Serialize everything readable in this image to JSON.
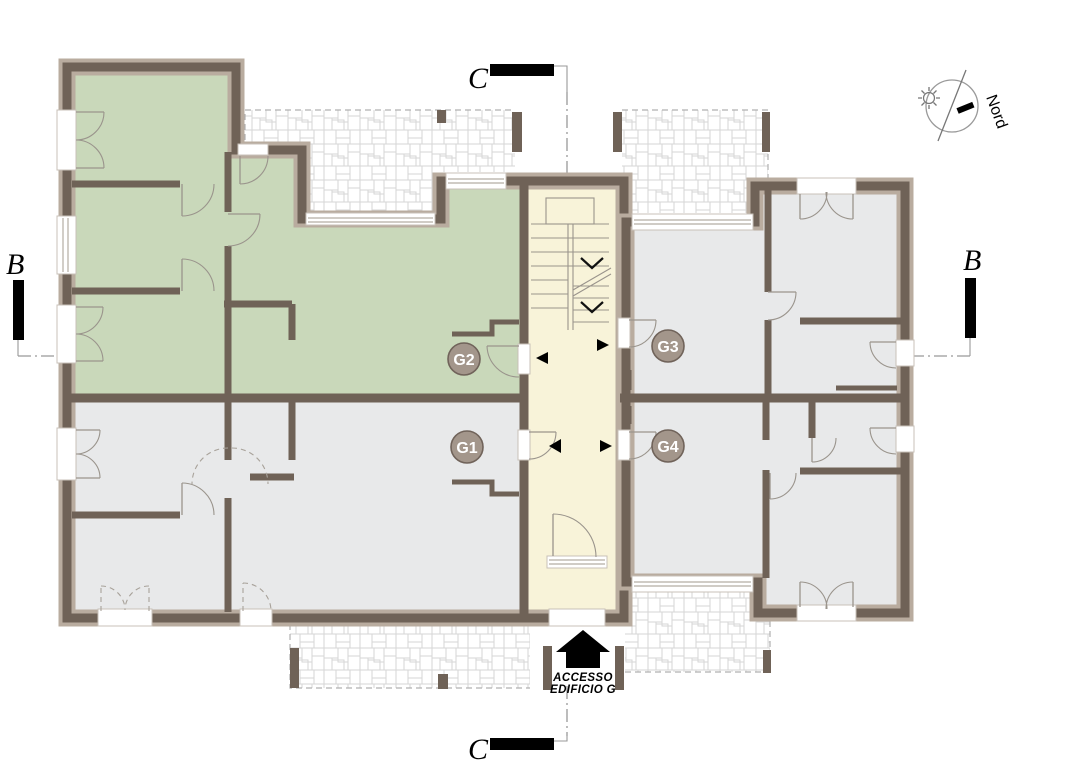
{
  "drawing": {
    "units": [
      {
        "id": "g1",
        "label": "G1"
      },
      {
        "id": "g2",
        "label": "G2"
      },
      {
        "id": "g3",
        "label": "G3"
      },
      {
        "id": "g4",
        "label": "G4"
      }
    ],
    "sections": {
      "b_label": "B",
      "c_label": "C"
    },
    "north": {
      "label": "Nord"
    },
    "access": {
      "line1": "ACCESSO",
      "line2": "EDIFICIO G"
    },
    "colors": {
      "unit_highlight": "#c9d8ba",
      "unit_neutral": "#e8e9ea",
      "stairwell": "#f8f3d9",
      "wall_core": "#6f6257",
      "wall_band": "#b9ac9f",
      "badge_fill": "#a3968b",
      "badge_border": "#70635a",
      "paving_line": "#d6d6d6",
      "ink": "#000000"
    }
  }
}
